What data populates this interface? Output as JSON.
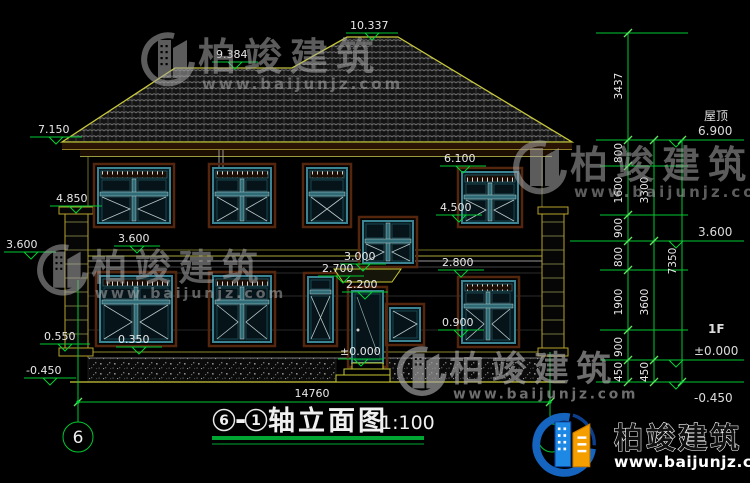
{
  "levels": {
    "eave_left": "7.150",
    "ridge_low": "9.384",
    "ridge_main": "10.337",
    "pillar_cap": "4.850",
    "floor2_left_out": "3.600",
    "floor2_left_in": "3.600",
    "plinth_left": "0.550",
    "ground_left": "-0.450",
    "plinth_mid": "0.350",
    "win2_top": "6.100",
    "win2_sill": "4.500",
    "stair_sill": "3.000",
    "canopy": "2.700",
    "door_top": "2.200",
    "win1_top": "2.800",
    "win1_small_sill": "0.900",
    "zero_door": "±0.000",
    "roof_label": "屋顶",
    "roof_right": "6.900",
    "floor2_right": "3.600",
    "floor_label": "1F",
    "zero_right": "±0.000",
    "ground_right": "-0.450"
  },
  "chains": {
    "h_ridge": "3437",
    "h1": "800",
    "h2": "1600",
    "h3": "900",
    "h4": "800",
    "h5": "1900",
    "h6": "900",
    "h7": "450",
    "f2": "3300",
    "f1": "3600",
    "base": "450",
    "total": "7350"
  },
  "plan": {
    "total_width": "14760"
  },
  "axis": {
    "bubble": "6"
  },
  "title": {
    "from": "6",
    "sep": "-",
    "to": "1",
    "text": "轴立面图",
    "scale": "1:100"
  },
  "brand": {
    "name": "柏竣建筑",
    "url": "www.baijunjz.com"
  },
  "colors": {
    "dim_green": "#00c832",
    "roof_outline": "#c8c83a",
    "underline_green": "#00a632"
  }
}
